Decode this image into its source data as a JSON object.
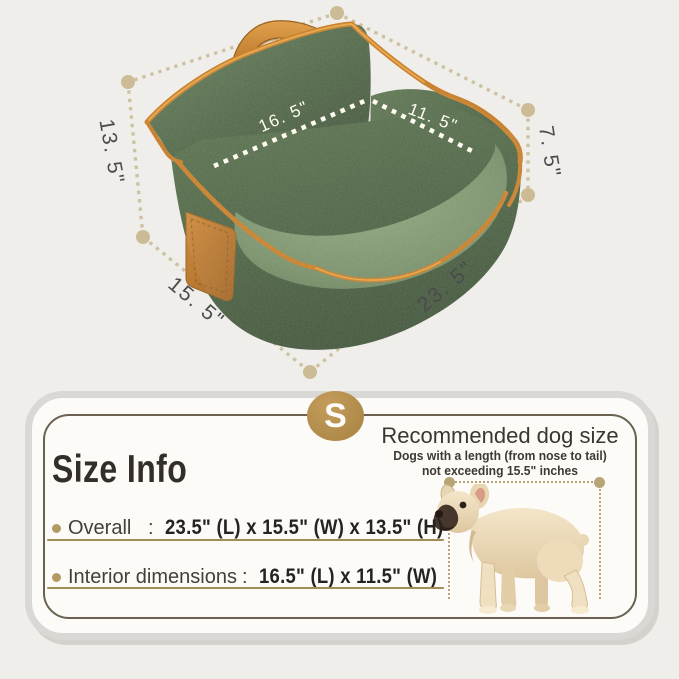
{
  "diagram": {
    "labels": {
      "overall_height": "13. 5\"",
      "back_height": "7. 5\"",
      "side_width": "15. 5\"",
      "front_length": "23. 5\"",
      "interior_length": "16. 5\"",
      "interior_width": "11. 5\""
    },
    "colors": {
      "dash_beige": "#cfc2a2",
      "bed_green_dark": "#4e6347",
      "bed_green_light": "#8fa47f",
      "trim_orange": "#c9822f",
      "label_gray": "#4b4b4b",
      "interior_label_white": "#fffdf4"
    }
  },
  "card": {
    "badge_letter": "S",
    "title": "Size Info",
    "recommended": {
      "heading": "Recommended dog size",
      "line1": "Dogs with a length (from nose to tail)",
      "line2": "not exceeding 15.5\"  inches"
    },
    "rows": [
      {
        "label": "Overall",
        "colon": ":",
        "value": "23.5\" (L) x 15.5\" (W) x 13.5\" (H)"
      },
      {
        "label": "Interior dimensions",
        "colon": ":",
        "value": "16.5\" (L) x 11.5\" (W)"
      }
    ],
    "colors": {
      "gold_badge": "#b5904f",
      "underline_tan": "#a18c58",
      "border_tan": "#6b6152"
    }
  }
}
